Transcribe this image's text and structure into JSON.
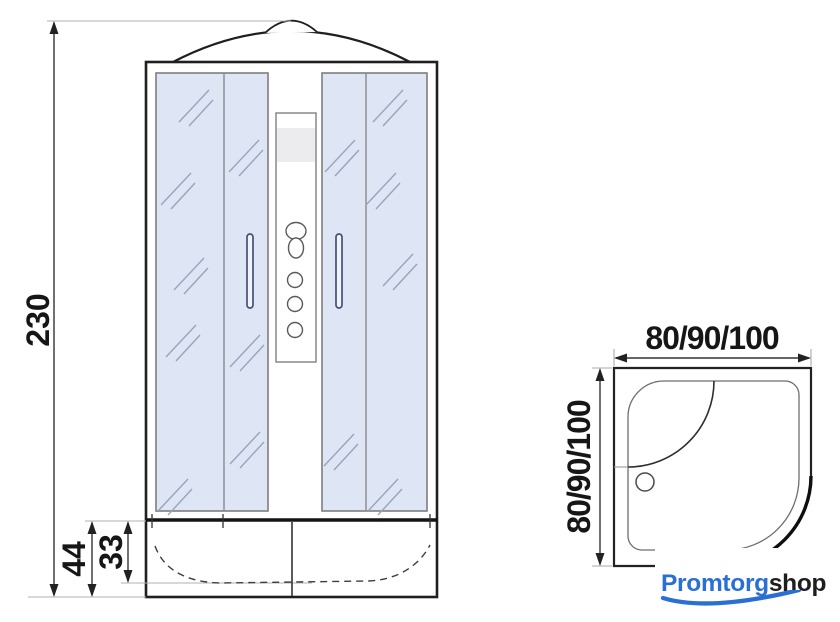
{
  "drawing": {
    "title": "shower cabin dimensional drawing",
    "front_view": {
      "height_label": "230",
      "base_height_label": "44",
      "tray_depth_label": "33"
    },
    "top_view": {
      "width_label": "80/90/100",
      "depth_label": "80/90/100"
    }
  },
  "branding": {
    "primary": "Promtorg",
    "secondary": "shop",
    "primary_color": "#2a6fd3",
    "secondary_color": "#1e1e1e"
  },
  "colors": {
    "glass_fill": "#dee5f4",
    "glass_reflection": "#9aa3bd",
    "outline": "#1f1f1f",
    "dimension_text": "#161616",
    "extension_line": "#b0b0b0"
  }
}
